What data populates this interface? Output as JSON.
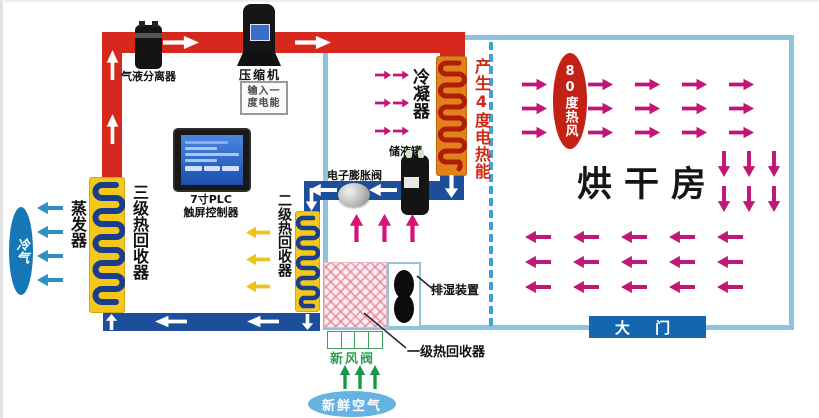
{
  "labels": {
    "gas_liquid_separator": "气液分离器",
    "compressor": "压缩机",
    "badge_line1": "输入一",
    "badge_line2": "度电能",
    "plc_line1": "7寸PLC",
    "plc_line2": "触屏控制器",
    "cold_air": "冷气",
    "evaporator": "蒸发器",
    "tertiary_heat_recovery": "三级热回收器",
    "secondary_heat_recovery": "二级热回收器",
    "condenser": "冷凝器",
    "heat_energy": "产生4度电热能",
    "liquid_receiver": "储液罐",
    "expansion_valve": "电子膨胀阀",
    "dehumidifier": "排湿装置",
    "primary_heat_recovery": "一级热回收器",
    "fresh_air_valve": "新风阀",
    "fresh_air": "新鲜空气",
    "hot_air_80": "80度热风",
    "drying_room": "烘干房",
    "main_door": "大 门"
  },
  "colors": {
    "hot_pipe": "#d6281c",
    "cold_pipe": "#1d4e9b",
    "room_border": "#8cc3de",
    "divider_dash": "#44a3d6",
    "coil_bg": "#f3c81a",
    "coil_line": "#1a3e8c",
    "condenser_bg": "#e2801c",
    "condenser_line": "#ae1e06",
    "hot_air_arrow": "#c21677",
    "cold_air_arrow": "#2d8fc2",
    "yellow_arrow": "#ebc41a",
    "green_arrow": "#149a46",
    "white_arrow": "#ffffff",
    "door_bg": "#1566ae",
    "hot_oval_bg": "#c32114",
    "cold_ellipse_bg": "#1577b5",
    "fresh_ellipse_bg": "#66b2e3",
    "heat_text": "#d02814",
    "fresh_valve_text": "#2f9e50"
  },
  "decor": {
    "arrow_grids": [
      {
        "name": "hot-air-right-arrow",
        "dir": "right",
        "color": "#c21677",
        "cols": [
          519,
          585,
          632,
          679,
          726
        ],
        "rows": [
          76,
          100,
          124
        ],
        "w": 25,
        "h": 13
      },
      {
        "name": "room-down-arrow",
        "dir": "down",
        "color": "#c21677",
        "cols": [
          714,
          739,
          764
        ],
        "rows": [
          149,
          184
        ],
        "w": 14,
        "h": 26
      },
      {
        "name": "room-left-arrow",
        "dir": "left",
        "color": "#c21677",
        "cols": [
          522,
          570,
          618,
          666,
          714
        ],
        "rows": [
          228,
          253,
          278
        ],
        "w": 26,
        "h": 14
      },
      {
        "name": "condenser-right-arrow",
        "dir": "right",
        "color": "#c21677",
        "cols": [
          372,
          390
        ],
        "rows": [
          68,
          96,
          124
        ],
        "w": 16,
        "h": 10
      }
    ],
    "arrows": [
      {
        "name": "pipe-flow-up-arrow",
        "dir": "up",
        "color": "#ffffff",
        "x": 103,
        "y": 48,
        "w": 13,
        "h": 30
      },
      {
        "name": "pipe-flow-up-arrow",
        "dir": "up",
        "color": "#ffffff",
        "x": 103,
        "y": 112,
        "w": 13,
        "h": 30
      },
      {
        "name": "pipe-flow-right-arrow",
        "dir": "right",
        "color": "#ffffff",
        "x": 160,
        "y": 33,
        "w": 36,
        "h": 15
      },
      {
        "name": "pipe-flow-right-arrow",
        "dir": "right",
        "color": "#ffffff",
        "x": 292,
        "y": 33,
        "w": 36,
        "h": 15
      },
      {
        "name": "pipe-flow-down-arrow",
        "dir": "down",
        "color": "#ffffff",
        "x": 441,
        "y": 173,
        "w": 15,
        "h": 23
      },
      {
        "name": "pipe-flow-left-arrow",
        "dir": "left",
        "color": "#ffffff",
        "x": 306,
        "y": 181,
        "w": 28,
        "h": 14
      },
      {
        "name": "pipe-flow-left-arrow",
        "dir": "left",
        "color": "#ffffff",
        "x": 366,
        "y": 181,
        "w": 28,
        "h": 14
      },
      {
        "name": "pipe-flow-down-arrow",
        "dir": "down",
        "color": "#ffffff",
        "x": 302,
        "y": 186,
        "w": 13,
        "h": 23
      },
      {
        "name": "pipe-flow-up-arrow",
        "dir": "up",
        "color": "#ffffff",
        "x": 102,
        "y": 312,
        "w": 13,
        "h": 16
      },
      {
        "name": "pipe-flow-left-arrow",
        "dir": "left",
        "color": "#ffffff",
        "x": 152,
        "y": 313,
        "w": 32,
        "h": 13
      },
      {
        "name": "pipe-flow-left-arrow",
        "dir": "left",
        "color": "#ffffff",
        "x": 244,
        "y": 313,
        "w": 32,
        "h": 13
      },
      {
        "name": "pipe-flow-down-arrow",
        "dir": "down",
        "color": "#ffffff",
        "x": 298,
        "y": 312,
        "w": 13,
        "h": 16
      },
      {
        "name": "cold-air-left-arrow",
        "dir": "left",
        "color": "#2d8fc2",
        "x": 34,
        "y": 199,
        "w": 26,
        "h": 14
      },
      {
        "name": "cold-air-left-arrow",
        "dir": "left",
        "color": "#2d8fc2",
        "x": 34,
        "y": 223,
        "w": 26,
        "h": 14
      },
      {
        "name": "cold-air-left-arrow",
        "dir": "left",
        "color": "#2d8fc2",
        "x": 34,
        "y": 247,
        "w": 26,
        "h": 14
      },
      {
        "name": "cold-air-left-arrow",
        "dir": "left",
        "color": "#2d8fc2",
        "x": 34,
        "y": 271,
        "w": 26,
        "h": 14
      },
      {
        "name": "recovery-left-arrow",
        "dir": "left",
        "color": "#ebc41a",
        "x": 243,
        "y": 224,
        "w": 24,
        "h": 13
      },
      {
        "name": "recovery-left-arrow",
        "dir": "left",
        "color": "#ebc41a",
        "x": 243,
        "y": 251,
        "w": 24,
        "h": 13
      },
      {
        "name": "recovery-left-arrow",
        "dir": "left",
        "color": "#ebc41a",
        "x": 243,
        "y": 278,
        "w": 24,
        "h": 13
      },
      {
        "name": "warm-air-up-arrow",
        "dir": "up",
        "color": "#d6137a",
        "x": 346,
        "y": 212,
        "w": 15,
        "h": 28
      },
      {
        "name": "warm-air-up-arrow",
        "dir": "up",
        "color": "#d6137a",
        "x": 374,
        "y": 212,
        "w": 15,
        "h": 28
      },
      {
        "name": "warm-air-up-arrow",
        "dir": "up",
        "color": "#d6137a",
        "x": 402,
        "y": 212,
        "w": 15,
        "h": 28
      },
      {
        "name": "fresh-air-up-arrow",
        "dir": "up",
        "color": "#149a46",
        "x": 336,
        "y": 363,
        "w": 12,
        "h": 24
      },
      {
        "name": "fresh-air-up-arrow",
        "dir": "up",
        "color": "#149a46",
        "x": 351,
        "y": 363,
        "w": 12,
        "h": 24
      },
      {
        "name": "fresh-air-up-arrow",
        "dir": "up",
        "color": "#149a46",
        "x": 366,
        "y": 363,
        "w": 12,
        "h": 24
      }
    ]
  }
}
